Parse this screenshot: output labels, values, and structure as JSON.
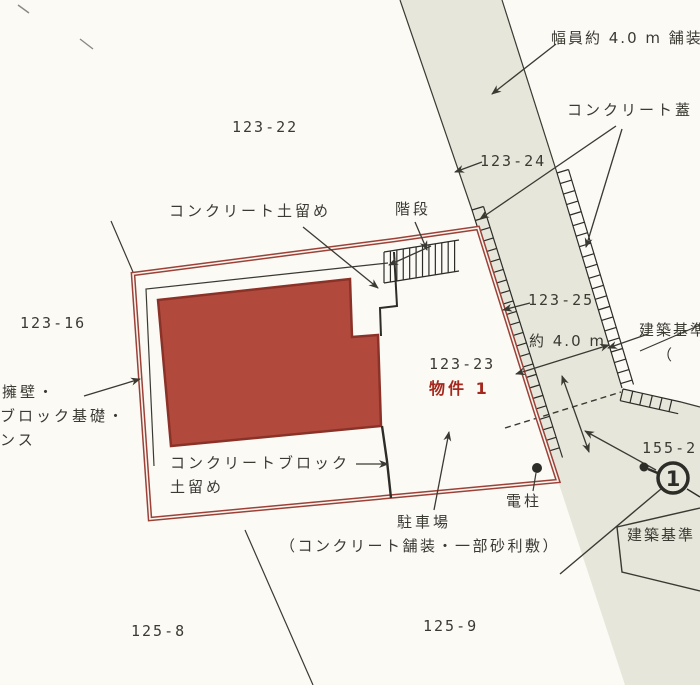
{
  "drawing_type": "cadastral-site-plan",
  "colors": {
    "background": "#fbfaf4",
    "road_fill": "#e7e6db",
    "boundary_red": "#9c4138",
    "building_fill": "#b14a3c",
    "building_border": "#8b3228",
    "line_black": "#3a3a33",
    "red_text": "#a5281f"
  },
  "parcels": {
    "p123_22": "123-22",
    "p123_24": "123-24",
    "p123_16": "123-16",
    "p123_25": "123-25",
    "p123_23": "123-23",
    "p155_2": "155-2",
    "p125_8": "125-8",
    "p125_9": "125-9"
  },
  "annotations": {
    "road_width": "幅員約 4.0 m 舗装",
    "concrete_lid": "コンクリート蓋",
    "concrete_retaining_wall": "コンクリート土留め",
    "stairs": "階段",
    "retaining_wall_note_line1": "擁壁・",
    "retaining_wall_note_line2": "ブロック基礎・",
    "retaining_wall_note_line3": "ンス",
    "approx_width": "約 4.0 m",
    "building_standard_right": "建築基準",
    "building_standard_right_paren": "（",
    "property_label": "物件 1",
    "concrete_block_line1": "コンクリートブロック",
    "concrete_block_line2": "土留め",
    "parking": "駐車場",
    "parking_note": "（コンクリート舗装・一部砂利敷）",
    "utility_pole": "電柱",
    "building_standard_bottom": "建築基準",
    "circle_marker_glyph": "1"
  }
}
